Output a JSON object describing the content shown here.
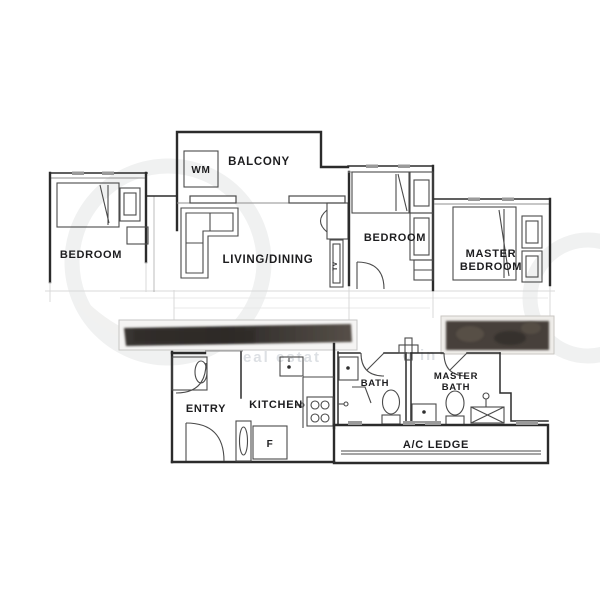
{
  "rooms": {
    "balcony": "BALCONY",
    "bedroom_left": "BEDROOM",
    "living_dining": "LIVING/DINING",
    "bedroom_middle": "BEDROOM",
    "master_bedroom": {
      "line1": "MASTER",
      "line2": "BEDROOM"
    },
    "entry": "ENTRY",
    "kitchen": "KITCHEN",
    "bath": "BATH",
    "master_bath": {
      "line1": "MASTER",
      "line2": "BATH"
    },
    "ac_ledge": "A/C LEDGE"
  },
  "appliances": {
    "washing_machine": "WM",
    "fridge": "F",
    "tv": "TV"
  },
  "watermark": {
    "visible_fragment_left": "eal estat",
    "visible_fragment_right": "o in"
  },
  "colors": {
    "wall": "#2b2b2b",
    "furniture": "#4a4a4a",
    "label": "#1d1d1f",
    "redaction_bar": "#47403a",
    "watermark_grey": "#c7cdd3",
    "background": "#ffffff"
  }
}
